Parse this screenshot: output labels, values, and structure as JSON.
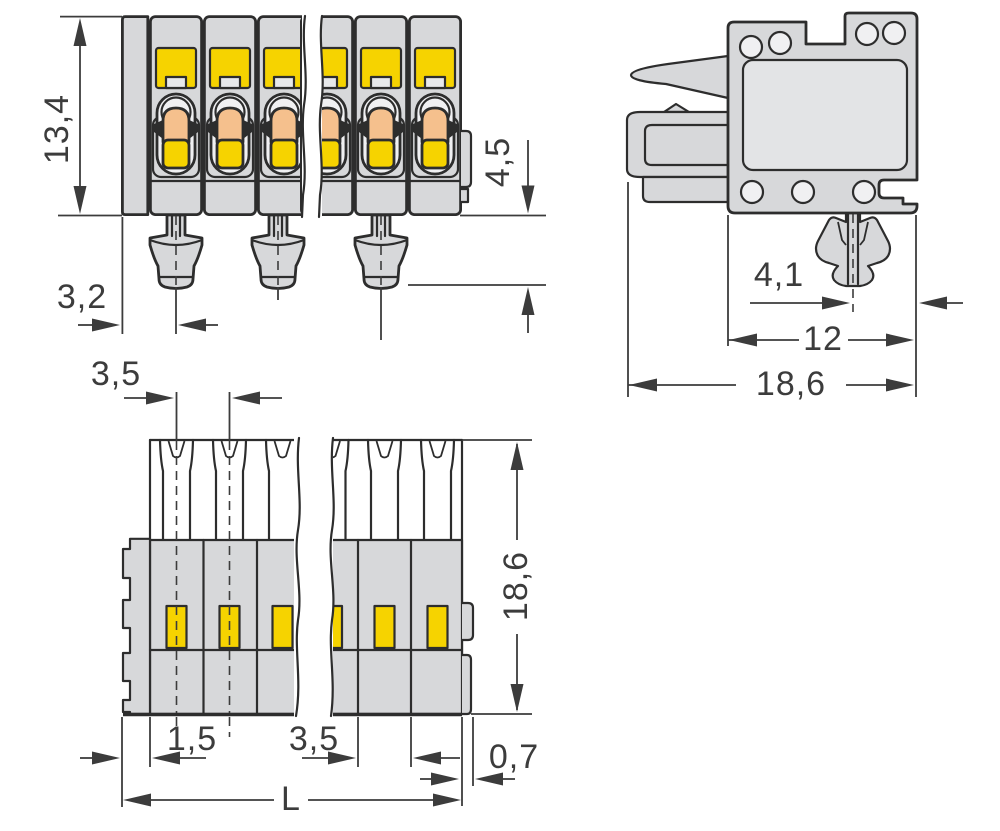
{
  "drawing": {
    "type": "connector-technical-drawing",
    "views": {
      "front": {
        "label": "front-view",
        "dimensions": {
          "height": "13,4",
          "left_offset": "3,2",
          "pin_length": "4,5"
        }
      },
      "side": {
        "label": "side-view",
        "dimensions": {
          "foot_offset": "4,1",
          "body_depth": "12",
          "total_depth": "18,6"
        }
      },
      "bottom": {
        "label": "bottom-view",
        "dimensions": {
          "pin_pitch_top": "3,5",
          "total_height": "18,6",
          "edge_offset": "1,5",
          "pin_pitch": "3,5",
          "wall_thickness": "0,7",
          "total_length": "L"
        }
      }
    },
    "colors": {
      "housing_gray": "#d7d8da",
      "actuator_yellow": "#f6d300",
      "lever_orange": "#f5c08d",
      "line": "#2d2d2d",
      "dimension": "#3c3c3c",
      "background": "#ffffff"
    }
  }
}
